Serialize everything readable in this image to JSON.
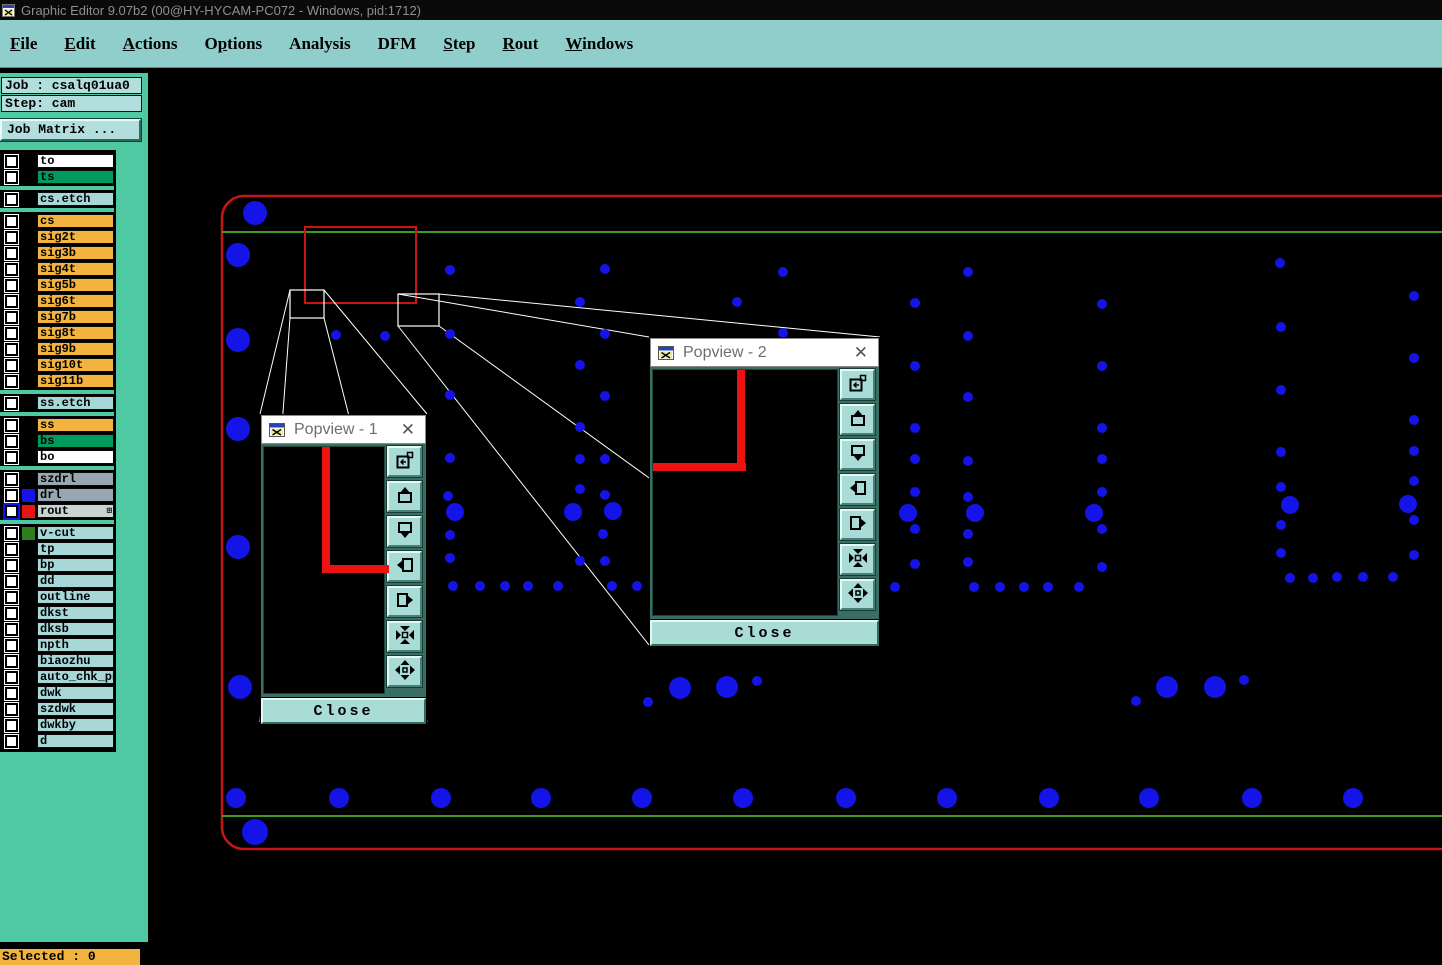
{
  "window": {
    "title": "Graphic Editor 9.07b2 (00@HY-HYCAM-PC072 - Windows, pid:1712)",
    "app_icon": "graphic-editor-app-icon"
  },
  "menu": {
    "items": [
      {
        "label": "File",
        "underline": 0
      },
      {
        "label": "Edit",
        "underline": 0
      },
      {
        "label": "Actions",
        "underline": 0
      },
      {
        "label": "Options",
        "underline": 1
      },
      {
        "label": "Analysis",
        "underline": -1
      },
      {
        "label": "DFM",
        "underline": -1
      },
      {
        "label": "Step",
        "underline": 0
      },
      {
        "label": "Rout",
        "underline": 0
      },
      {
        "label": "Windows",
        "underline": 0
      }
    ]
  },
  "sidebar": {
    "job_label": "Job : csalq01ua0",
    "step_label": "Step: cam",
    "job_matrix_button": "Job Matrix ...",
    "selected_label": "Selected : 0",
    "layer_groups": [
      {
        "layers": [
          {
            "name": "to",
            "bg": "#FFFFFF"
          },
          {
            "name": "ts",
            "bg": "#009A5F"
          }
        ]
      },
      {
        "layers": [
          {
            "name": "cs.etch",
            "bg": "#A7D7D6"
          }
        ]
      },
      {
        "layers": [
          {
            "name": "cs",
            "bg": "#F2B43E"
          },
          {
            "name": "sig2t",
            "bg": "#F2B43E"
          },
          {
            "name": "sig3b",
            "bg": "#F2B43E"
          },
          {
            "name": "sig4t",
            "bg": "#F2B43E"
          },
          {
            "name": "sig5b",
            "bg": "#F2B43E"
          },
          {
            "name": "sig6t",
            "bg": "#F2B43E"
          },
          {
            "name": "sig7b",
            "bg": "#F2B43E"
          },
          {
            "name": "sig8t",
            "bg": "#F2B43E"
          },
          {
            "name": "sig9b",
            "bg": "#F2B43E"
          },
          {
            "name": "sig10t",
            "bg": "#F2B43E"
          },
          {
            "name": "sig11b",
            "bg": "#F2B43E"
          }
        ]
      },
      {
        "layers": [
          {
            "name": "ss.etch",
            "bg": "#A7D7D6"
          }
        ]
      },
      {
        "layers": [
          {
            "name": "ss",
            "bg": "#F2B43E"
          },
          {
            "name": "bs",
            "bg": "#009A5F"
          },
          {
            "name": "bo",
            "bg": "#FFFFFF"
          }
        ]
      },
      {
        "layers": [
          {
            "name": "szdrl",
            "bg": "#97A6B0"
          },
          {
            "name": "drl",
            "bg": "#97A6B0",
            "chip": "#1414E8"
          },
          {
            "name": "rout",
            "bg": "#C9D4D2",
            "chip": "#E81414",
            "active": true,
            "grid_icon": "⊞"
          }
        ]
      },
      {
        "layers": [
          {
            "name": "v-cut",
            "bg": "#A7D7D6",
            "chip": "#2E7D1F"
          },
          {
            "name": "tp",
            "bg": "#A7D7D6"
          },
          {
            "name": "bp",
            "bg": "#A7D7D6"
          },
          {
            "name": "dd",
            "bg": "#A7D7D6"
          },
          {
            "name": "outline",
            "bg": "#A7D7D6"
          },
          {
            "name": "dkst",
            "bg": "#A7D7D6"
          },
          {
            "name": "dksb",
            "bg": "#A7D7D6"
          },
          {
            "name": "npth",
            "bg": "#A7D7D6"
          },
          {
            "name": "biaozhu",
            "bg": "#A7D7D6"
          },
          {
            "name": "auto_chk_pnl",
            "bg": "#A7D7D6"
          },
          {
            "name": "dwk",
            "bg": "#A7D7D6"
          },
          {
            "name": "szdwk",
            "bg": "#A7D7D6"
          },
          {
            "name": "dwkby",
            "bg": "#A7D7D6"
          },
          {
            "name": "d",
            "bg": "#A7D7D6"
          }
        ]
      }
    ]
  },
  "popviews": [
    {
      "title": "Popview - 1",
      "close_label": "Close",
      "close_x": "✕"
    },
    {
      "title": "Popview - 2",
      "close_label": "Close",
      "close_x": "✕"
    }
  ],
  "popview_toolbar_icons": [
    "copy-view-icon",
    "pan-up-icon",
    "pan-down-icon",
    "pan-left-icon",
    "pan-right-icon",
    "zoom-contract-icon",
    "zoom-expand-icon"
  ],
  "canvas": {
    "colors": {
      "dot_blue": "#1414E8",
      "outline_red": "#C81414",
      "profile_green": "#3C9C1C",
      "callout_white": "#FFFFFF"
    },
    "panel_border": {
      "x": 222,
      "y": 196,
      "w": 1295,
      "h": 653,
      "rx": 22
    },
    "green_lines": [
      {
        "x1": 222,
        "y1": 232,
        "x2": 1442,
        "y2": 232
      },
      {
        "x1": 222,
        "y1": 816,
        "x2": 1442,
        "y2": 816
      }
    ],
    "selection_rect": {
      "x": 305,
      "y": 227,
      "w": 111,
      "h": 76
    },
    "zoom_boxes": [
      {
        "x": 290,
        "y": 290,
        "w": 34,
        "h": 28
      },
      {
        "x": 398,
        "y": 294,
        "w": 41,
        "h": 32
      }
    ],
    "dots_large": [
      [
        255,
        213,
        12
      ],
      [
        238,
        255,
        12
      ],
      [
        238,
        340,
        12
      ],
      [
        238,
        429,
        12
      ],
      [
        238,
        547,
        12
      ],
      [
        240,
        687,
        12
      ],
      [
        255,
        832,
        13
      ],
      [
        236,
        798,
        10
      ],
      [
        339,
        798,
        10
      ],
      [
        441,
        798,
        10
      ],
      [
        541,
        798,
        10
      ],
      [
        642,
        798,
        10
      ],
      [
        743,
        798,
        10
      ],
      [
        846,
        798,
        10
      ],
      [
        947,
        798,
        10
      ],
      [
        1049,
        798,
        10
      ],
      [
        1149,
        798,
        10
      ],
      [
        1252,
        798,
        10
      ],
      [
        1353,
        798,
        10
      ],
      [
        680,
        688,
        11
      ],
      [
        727,
        687,
        11
      ],
      [
        1167,
        687,
        11
      ],
      [
        1215,
        687,
        11
      ],
      [
        455,
        512,
        9
      ],
      [
        573,
        512,
        9
      ],
      [
        613,
        511,
        9
      ],
      [
        908,
        513,
        9
      ],
      [
        975,
        513,
        9
      ],
      [
        1094,
        513,
        9
      ],
      [
        1290,
        505,
        9
      ],
      [
        1408,
        504,
        9
      ]
    ],
    "dots_small": [
      [
        648,
        702,
        5
      ],
      [
        757,
        681,
        5
      ],
      [
        1136,
        701,
        5
      ],
      [
        1244,
        680,
        5
      ],
      [
        336,
        335,
        5
      ],
      [
        385,
        336,
        5
      ],
      [
        450,
        270,
        5
      ],
      [
        450,
        334,
        5
      ],
      [
        450,
        395,
        5
      ],
      [
        450,
        458,
        5
      ],
      [
        448,
        496,
        5
      ],
      [
        450,
        535,
        5
      ],
      [
        450,
        558,
        5
      ],
      [
        580,
        302,
        5
      ],
      [
        580,
        365,
        5
      ],
      [
        580,
        427,
        5
      ],
      [
        580,
        459,
        5
      ],
      [
        580,
        489,
        5
      ],
      [
        580,
        561,
        5
      ],
      [
        605,
        269,
        5
      ],
      [
        605,
        334,
        5
      ],
      [
        605,
        396,
        5
      ],
      [
        605,
        459,
        5
      ],
      [
        605,
        495,
        5
      ],
      [
        603,
        534,
        5
      ],
      [
        605,
        561,
        5
      ],
      [
        737,
        302,
        5
      ],
      [
        783,
        272,
        5
      ],
      [
        783,
        333,
        5
      ],
      [
        915,
        303,
        5
      ],
      [
        915,
        366,
        5
      ],
      [
        915,
        428,
        5
      ],
      [
        915,
        459,
        5
      ],
      [
        915,
        492,
        5
      ],
      [
        915,
        529,
        5
      ],
      [
        915,
        564,
        5
      ],
      [
        968,
        272,
        5
      ],
      [
        968,
        336,
        5
      ],
      [
        968,
        397,
        5
      ],
      [
        968,
        461,
        5
      ],
      [
        968,
        497,
        5
      ],
      [
        968,
        534,
        5
      ],
      [
        968,
        562,
        5
      ],
      [
        1102,
        304,
        5
      ],
      [
        1102,
        366,
        5
      ],
      [
        1102,
        428,
        5
      ],
      [
        1102,
        459,
        5
      ],
      [
        1102,
        492,
        5
      ],
      [
        1102,
        529,
        5
      ],
      [
        1102,
        567,
        5
      ],
      [
        1280,
        263,
        5
      ],
      [
        1281,
        327,
        5
      ],
      [
        1281,
        390,
        5
      ],
      [
        1281,
        452,
        5
      ],
      [
        1281,
        487,
        5
      ],
      [
        1281,
        525,
        5
      ],
      [
        1281,
        553,
        5
      ],
      [
        1414,
        296,
        5
      ],
      [
        1414,
        358,
        5
      ],
      [
        1414,
        420,
        5
      ],
      [
        1414,
        451,
        5
      ],
      [
        1414,
        481,
        5
      ],
      [
        1414,
        520,
        5
      ],
      [
        1414,
        555,
        5
      ],
      [
        453,
        586,
        5
      ],
      [
        480,
        586,
        5
      ],
      [
        505,
        586,
        5
      ],
      [
        528,
        586,
        5
      ],
      [
        558,
        586,
        5
      ],
      [
        612,
        586,
        5
      ],
      [
        637,
        586,
        5
      ],
      [
        895,
        587,
        5
      ],
      [
        974,
        587,
        5
      ],
      [
        1000,
        587,
        5
      ],
      [
        1024,
        587,
        5
      ],
      [
        1048,
        587,
        5
      ],
      [
        1079,
        587,
        5
      ],
      [
        1290,
        578,
        5
      ],
      [
        1313,
        578,
        5
      ],
      [
        1337,
        577,
        5
      ],
      [
        1363,
        577,
        5
      ],
      [
        1393,
        577,
        5
      ]
    ]
  }
}
